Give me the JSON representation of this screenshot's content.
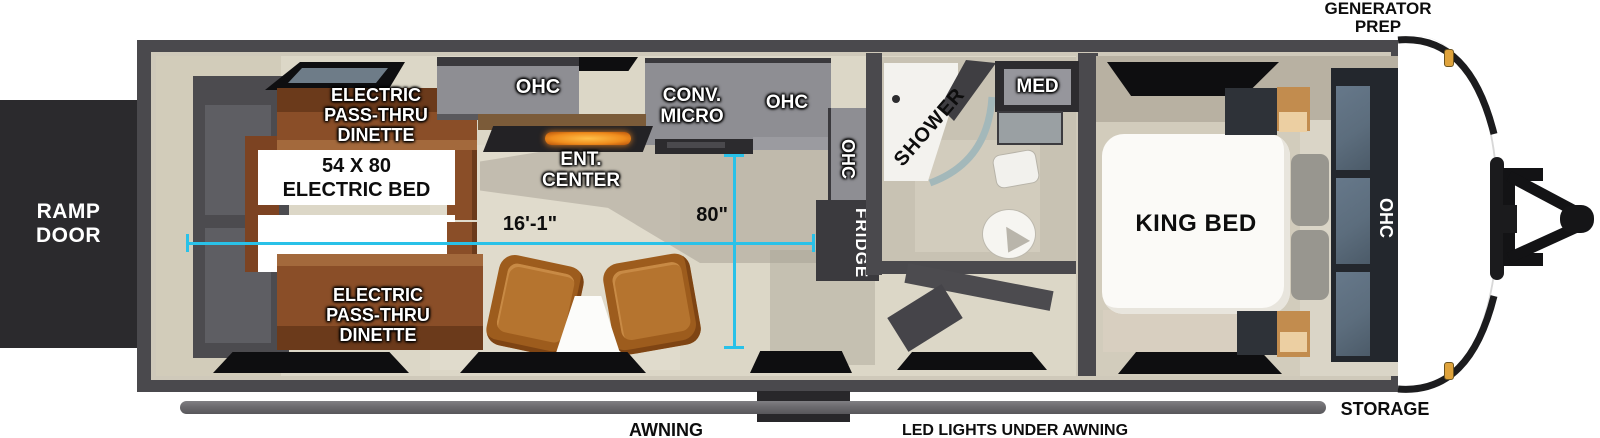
{
  "exterior": {
    "generator_prep": "GENERATOR\nPREP",
    "ramp_door": "RAMP\nDOOR",
    "storage": "STORAGE",
    "awning": "AWNING",
    "led_lights": "LED LIGHTS UNDER AWNING"
  },
  "interior": {
    "dinette_top": "ELECTRIC\nPASS-THRU\nDINETTE",
    "dinette_bottom": "ELECTRIC\nPASS-THRU\nDINETTE",
    "electric_bed": "54 X 80\nELECTRIC BED",
    "ohc_left": "OHC",
    "conv_micro": "CONV.\nMICRO",
    "ohc_kitchen": "OHC",
    "ent_center": "ENT.\nCENTER",
    "ohc_kitchen_side": "OHC",
    "fridge": "FRIDGE",
    "shower": "SHOWER",
    "med": "MED",
    "king_bed": "KING BED",
    "ohc_bedroom": "OHC"
  },
  "measurements": {
    "length": "16'-1\"",
    "width": "80\""
  },
  "colors": {
    "dimension_line": "#29c1e8",
    "wall": "#4a494d",
    "floor": "#dcd7c7",
    "dinette_wood": "#8a4e28",
    "cabinet_gray": "#8e8e93",
    "marker_light": "#dfa33c",
    "label_white": "#ffffff",
    "label_black": "#0d0d0d"
  }
}
